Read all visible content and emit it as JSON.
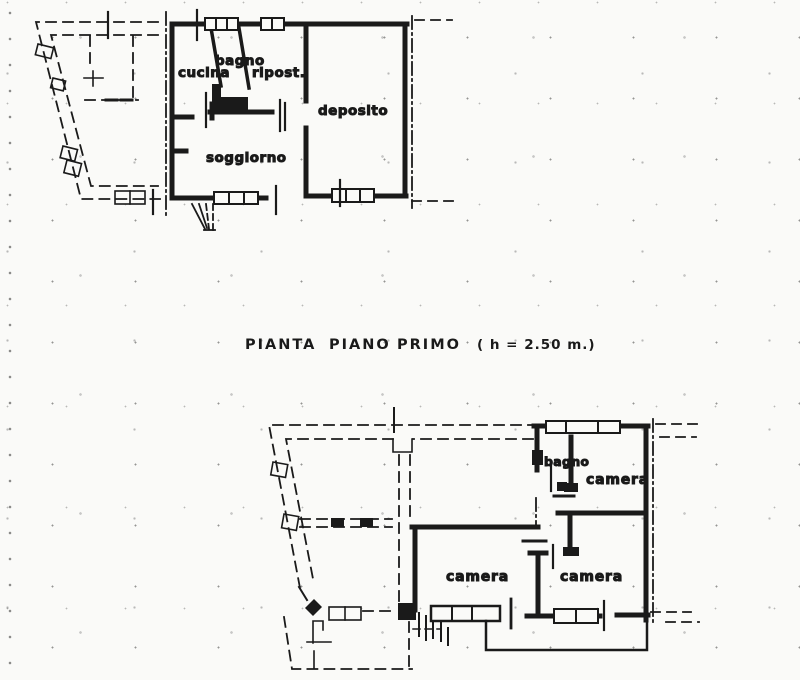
{
  "title": {
    "w1": "PIANTA",
    "w2": "PIANO",
    "w3": "PRIMO",
    "note": "( h = 2.50  m.)"
  },
  "plan_top": {
    "rooms": {
      "cucina": "cucina",
      "bagno": "bagno",
      "ripost": "ripost.",
      "soggiorno": "soggiorno",
      "deposito": "deposito"
    }
  },
  "plan_bottom": {
    "rooms": {
      "bagno": "bagno",
      "camera_top": "camera",
      "camera_left": "camera",
      "camera_right": "camera"
    }
  },
  "colors": {
    "ink": "#1a1a1a",
    "paper": "#fafaf8"
  }
}
